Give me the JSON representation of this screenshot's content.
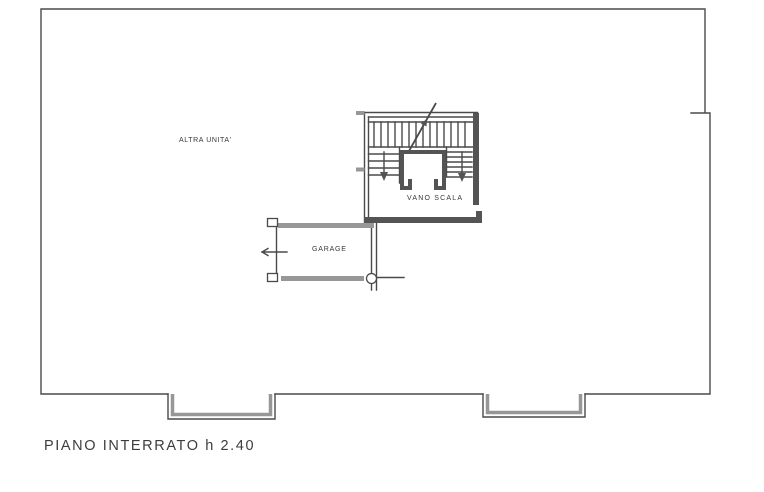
{
  "plan": {
    "caption": "PIANO INTERRATO h 2.40",
    "rooms": {
      "altra_unita": "ALTRA UNITA'",
      "vano_scala": "VANO SCALA",
      "garage": "GARAGE"
    },
    "colors": {
      "line": "#4a4a4a",
      "wall_dark": "#545454",
      "wall_gray": "#979797",
      "paper": "#ffffff"
    }
  }
}
